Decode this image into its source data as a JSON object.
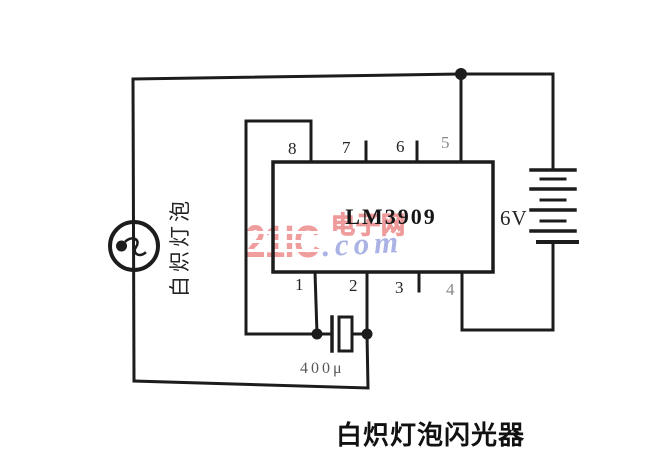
{
  "watermark": {
    "brand": "21IC",
    "site_cn": "电子网",
    "domain_suffix": ".com",
    "brand_color": "#ef9d9d",
    "suffix_color": "#aab3e3"
  },
  "circuit": {
    "ic": {
      "label": "LM3909",
      "pins_top": [
        "8",
        "7",
        "6",
        "5"
      ],
      "pins_bottom": [
        "1",
        "2",
        "3",
        "4"
      ]
    },
    "battery": {
      "label": "6V"
    },
    "capacitor": {
      "label": "400μ"
    },
    "lamp": {
      "label": "白炽灯泡"
    },
    "caption": "白炽灯泡闪光器",
    "line_color": "#1c1c1c"
  }
}
